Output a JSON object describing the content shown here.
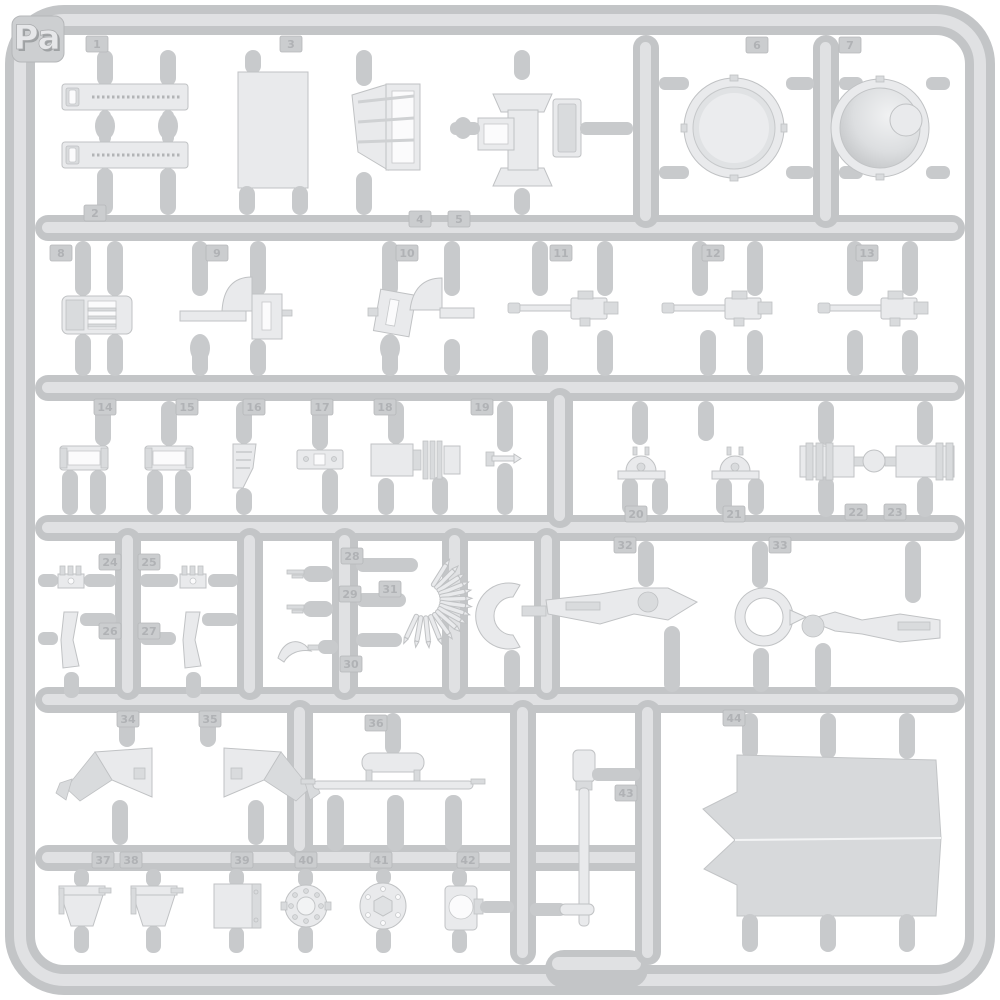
{
  "photo": {
    "subject": "Light-gray injection-molded plastic model-kit parts sprue photographed on a white background",
    "plastic_color_hex": "#cdcfd1",
    "background_hex": "#ffffff",
    "visible_part_numbers": "1-44"
  },
  "sprue": {
    "label": "Pa",
    "tags": [
      {
        "n": "1",
        "x": 97,
        "y": 44
      },
      {
        "n": "2",
        "x": 95,
        "y": 213
      },
      {
        "n": "3",
        "x": 291,
        "y": 44
      },
      {
        "n": "4",
        "x": 420,
        "y": 219
      },
      {
        "n": "5",
        "x": 459,
        "y": 219
      },
      {
        "n": "6",
        "x": 757,
        "y": 45
      },
      {
        "n": "7",
        "x": 850,
        "y": 45
      },
      {
        "n": "8",
        "x": 61,
        "y": 253
      },
      {
        "n": "9",
        "x": 217,
        "y": 253
      },
      {
        "n": "10",
        "x": 407,
        "y": 253
      },
      {
        "n": "11",
        "x": 561,
        "y": 253
      },
      {
        "n": "12",
        "x": 713,
        "y": 253
      },
      {
        "n": "13",
        "x": 867,
        "y": 253
      },
      {
        "n": "14",
        "x": 105,
        "y": 407
      },
      {
        "n": "15",
        "x": 187,
        "y": 407
      },
      {
        "n": "16",
        "x": 254,
        "y": 407
      },
      {
        "n": "17",
        "x": 322,
        "y": 407
      },
      {
        "n": "18",
        "x": 385,
        "y": 407
      },
      {
        "n": "19",
        "x": 482,
        "y": 407
      },
      {
        "n": "20",
        "x": 636,
        "y": 514
      },
      {
        "n": "21",
        "x": 734,
        "y": 514
      },
      {
        "n": "22",
        "x": 856,
        "y": 512
      },
      {
        "n": "23",
        "x": 895,
        "y": 512
      },
      {
        "n": "24",
        "x": 110,
        "y": 562
      },
      {
        "n": "25",
        "x": 149,
        "y": 562
      },
      {
        "n": "26",
        "x": 110,
        "y": 631
      },
      {
        "n": "27",
        "x": 149,
        "y": 631
      },
      {
        "n": "28",
        "x": 352,
        "y": 556
      },
      {
        "n": "29",
        "x": 350,
        "y": 594
      },
      {
        "n": "30",
        "x": 351,
        "y": 664
      },
      {
        "n": "31",
        "x": 390,
        "y": 589
      },
      {
        "n": "32",
        "x": 625,
        "y": 545
      },
      {
        "n": "33",
        "x": 780,
        "y": 545
      },
      {
        "n": "34",
        "x": 128,
        "y": 719
      },
      {
        "n": "35",
        "x": 210,
        "y": 719
      },
      {
        "n": "36",
        "x": 376,
        "y": 723
      },
      {
        "n": "37",
        "x": 103,
        "y": 860
      },
      {
        "n": "38",
        "x": 131,
        "y": 860
      },
      {
        "n": "39",
        "x": 242,
        "y": 860
      },
      {
        "n": "40",
        "x": 306,
        "y": 860
      },
      {
        "n": "41",
        "x": 381,
        "y": 860
      },
      {
        "n": "42",
        "x": 468,
        "y": 860
      },
      {
        "n": "43",
        "x": 626,
        "y": 793
      },
      {
        "n": "44",
        "x": 734,
        "y": 718
      }
    ]
  }
}
